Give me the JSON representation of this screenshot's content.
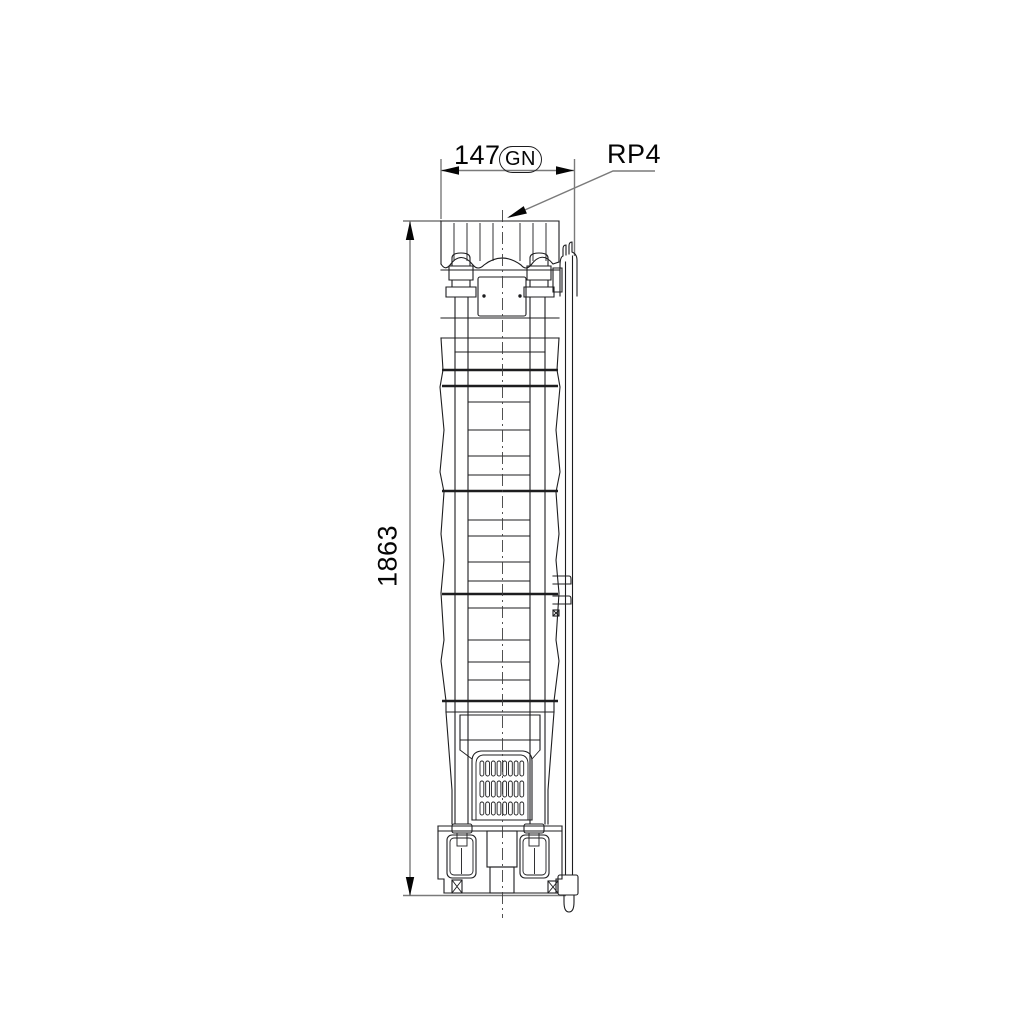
{
  "drawing": {
    "labels": {
      "width_value": "147",
      "width_badge": "GN",
      "top_connection": "RP4",
      "height_value": "1863"
    },
    "colors": {
      "background": "#ffffff",
      "line": "#1d1d1f",
      "dimension": "#7a7a7a",
      "text": "#050505"
    }
  }
}
